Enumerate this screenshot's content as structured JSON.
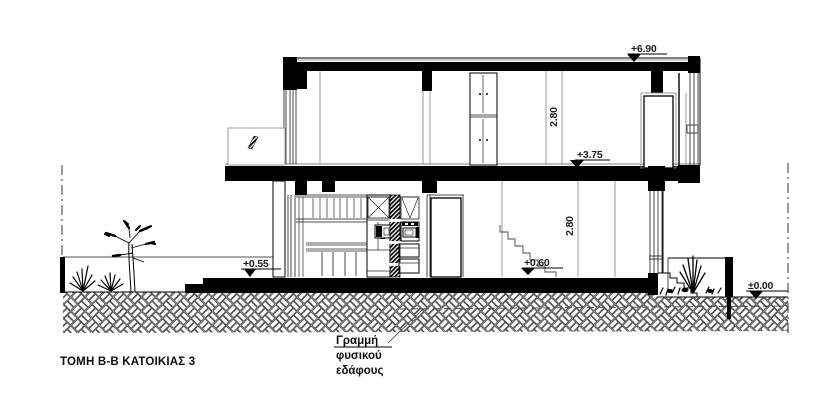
{
  "sheet": {
    "title": "ΤΟΜΗ Β-Β ΚΑΤΟΙΚΙΑΣ 3",
    "levels": {
      "roof": "+6.90",
      "first_floor": "+3.75",
      "terrace": "+0.55",
      "ground_floor": "+0.60",
      "site_datum": "±0.00"
    },
    "room_heights": {
      "upper": "2.80",
      "lower": "2.80"
    },
    "annotations": {
      "natural_ground_line1": "Γραμμή",
      "natural_ground_line2": "φυσικού",
      "natural_ground_line3": "εδάφους"
    },
    "colors": {
      "ink": "#000000",
      "secondary_line": "#8c8c8c",
      "paper": "#ffffff"
    }
  }
}
